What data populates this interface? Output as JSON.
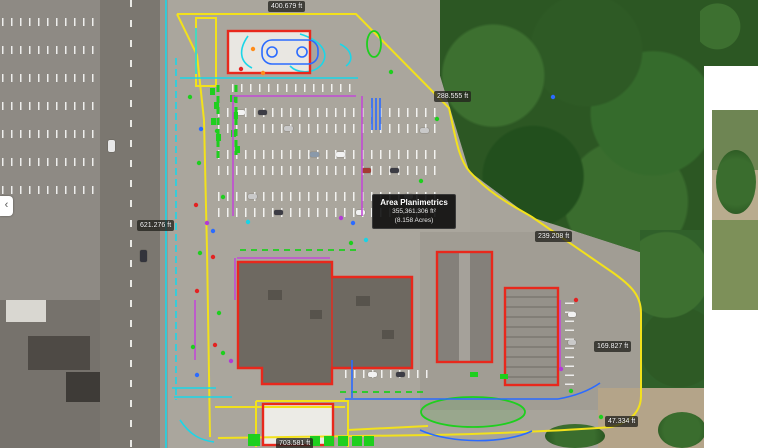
{
  "area_tooltip": {
    "title": "Area Planimetrics",
    "area_sqft": "355,361.306 ft²",
    "area_acres": "(8.158 Acres)"
  },
  "measurements": [
    {
      "id": "north",
      "text": "400.679 ft"
    },
    {
      "id": "northeast",
      "text": "288.555 ft"
    },
    {
      "id": "east-upper",
      "text": "239.208 ft"
    },
    {
      "id": "east-lower",
      "text": "169.827 ft"
    },
    {
      "id": "southeast",
      "text": "47.334 ft"
    },
    {
      "id": "west",
      "text": "621.276 ft"
    },
    {
      "id": "south",
      "text": "703.581 ft"
    }
  ],
  "icons": {
    "chevron_left": "‹"
  },
  "colors": {
    "boundary_yellow": "#f2e11c",
    "building_red": "#e8281c",
    "landscape_green": "#1ecf1e",
    "curb_cyan": "#1bd6e8",
    "detail_blue": "#2b6bff",
    "detail_magenta": "#c24ad6",
    "label_background": "rgba(35,35,30,0.78)"
  }
}
